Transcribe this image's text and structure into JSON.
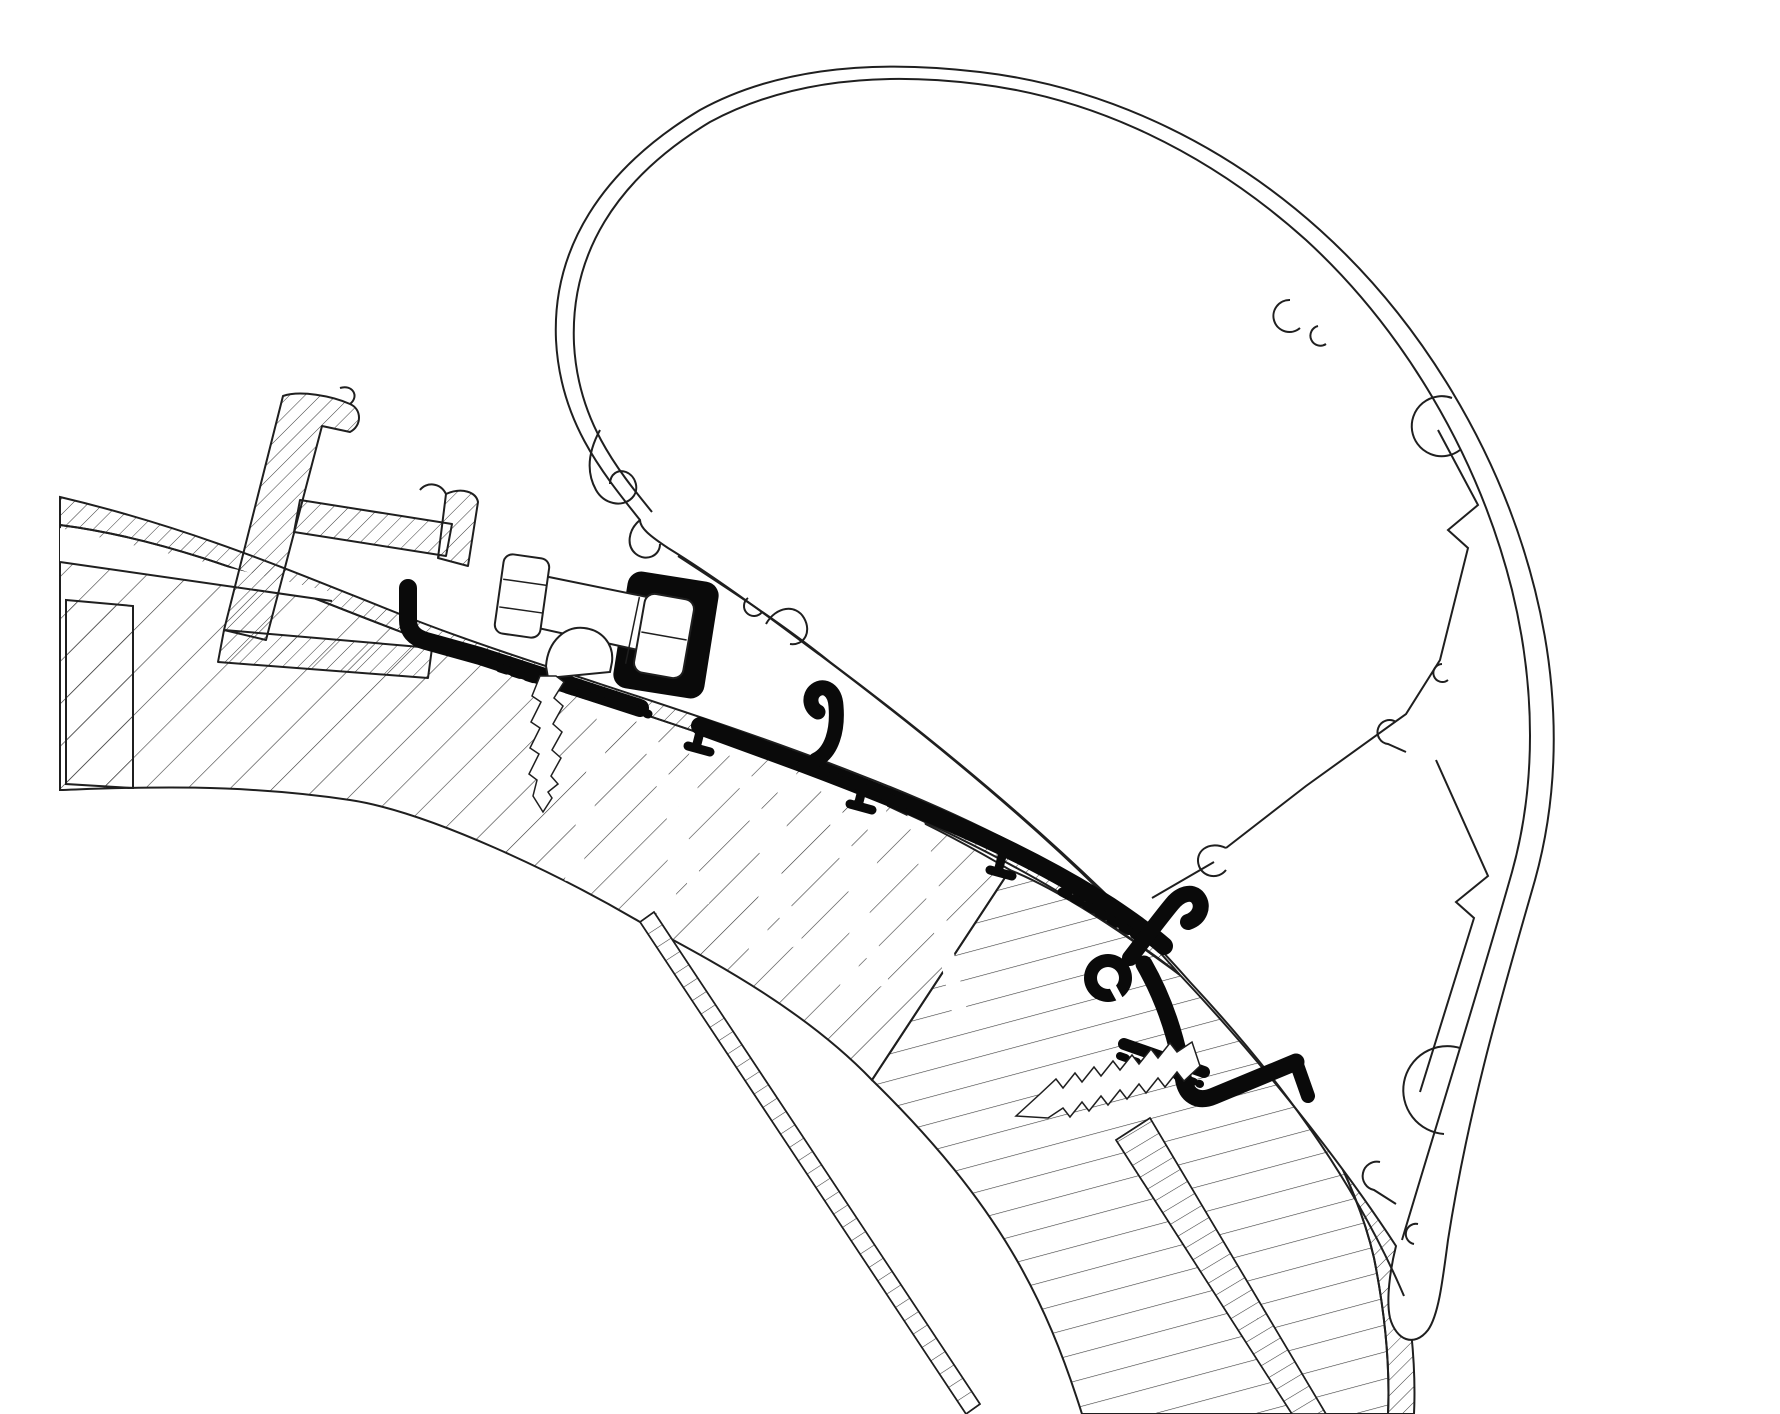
{
  "canvas": {
    "width": 1780,
    "height": 1414,
    "background": "#ffffff"
  },
  "style": {
    "line": "#1f1f1f",
    "hatch_line": "#3a3a3a",
    "profile_black": "#0a0a0a",
    "white": "#ffffff"
  },
  "drawing": {
    "kind": "technical cross-section line drawing",
    "text_labels": [],
    "parts": [
      {
        "name": "awning-cassette-profile",
        "render": "thin double-line rounded housing outline, top right"
      },
      {
        "name": "cassette-internal-walls",
        "render": "zigzag internal ribs with C-shaped screw bosses"
      },
      {
        "name": "cassette-tail-hooks",
        "render": "C-hook and small hooklets at lower end of housing"
      },
      {
        "name": "fabric-hook-spiral",
        "render": "spiral lip where housing edge curls at left"
      },
      {
        "name": "roof-rail-profile",
        "render": "hatched extruded rail, top left"
      },
      {
        "name": "hex-bolt",
        "render": "side-view hex bolt clamping adapter"
      },
      {
        "name": "flange-nut",
        "render": "white nut inside black adapter pocket"
      },
      {
        "name": "adapter-profile",
        "render": "thick solid black mounting adapter following roof curve"
      },
      {
        "name": "adapter-serrations",
        "render": "toothed underside runs of adapter base"
      },
      {
        "name": "roof-skin",
        "render": "finely hatched outer roof skin band"
      },
      {
        "name": "roof-core",
        "render": "wide-hatched sandwich core with insulation zigzags"
      },
      {
        "name": "wall-core",
        "render": "shallow-hatched side wall core, lower right"
      },
      {
        "name": "inner-liner-band",
        "render": "thin rung ladder band peeling to bottom"
      },
      {
        "name": "wall-skin-band",
        "render": "rung band along outer wall edge"
      },
      {
        "name": "roof-screw",
        "render": "threaded screw with dome head through adapter base"
      },
      {
        "name": "wall-screw",
        "render": "threaded screw driven diagonally into wall"
      }
    ]
  }
}
